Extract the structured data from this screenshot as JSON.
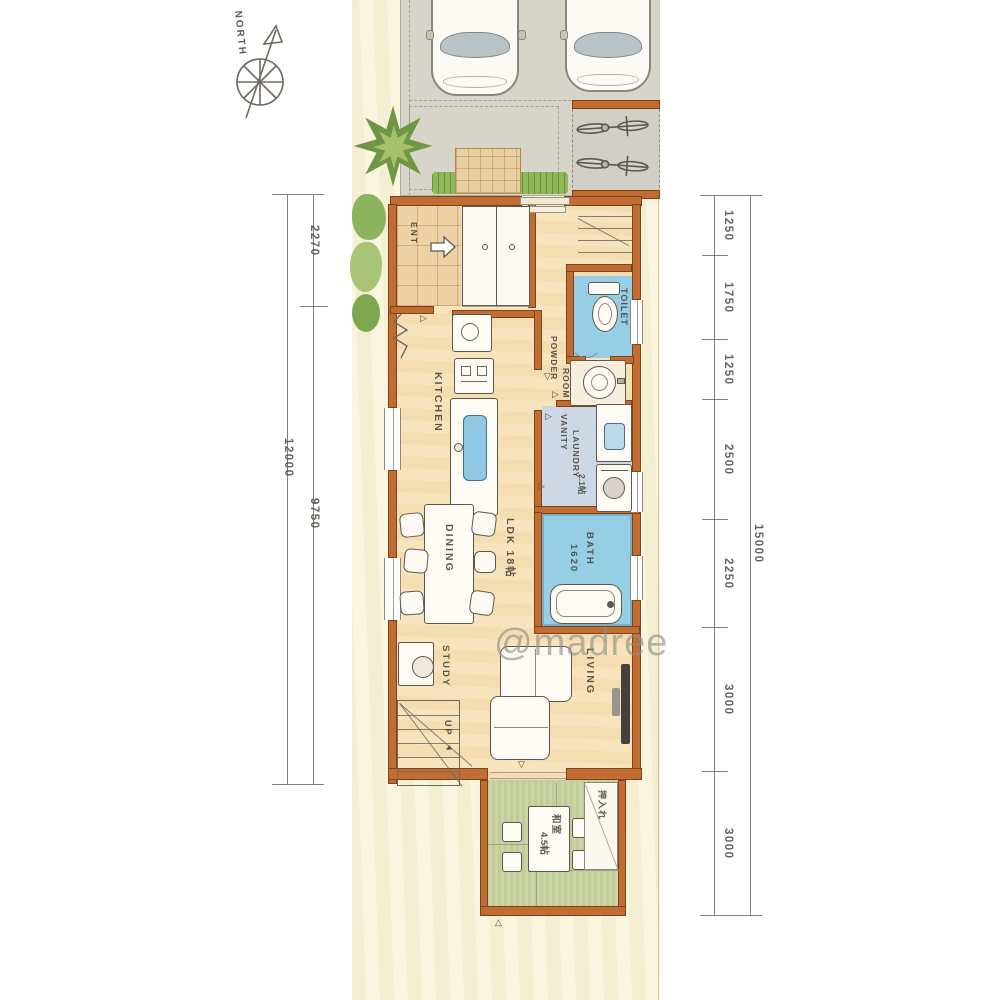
{
  "watermark": "@madree",
  "compass": {
    "north": "NORTH"
  },
  "dimensions": {
    "left_total": "12000",
    "left_seg1": "2270",
    "left_seg2": "9750",
    "right_total": "15000",
    "right_segments": [
      "1250",
      "1750",
      "1250",
      "2500",
      "2250",
      "3000",
      "3000"
    ]
  },
  "rooms": {
    "entry": "ENT",
    "toilet": "TOILET",
    "powder_line1": "POWDER",
    "powder_line2": "ROOM",
    "kitchen": "KITCHEN",
    "vanity_line1": "VANITY",
    "vanity_line2": "LAUNDRY",
    "vanity_line3": "2.1帖",
    "bath_line1": "BATH",
    "bath_line2": "1620",
    "dining": "DINING",
    "ldk": "LDK 18帖",
    "study": "STUDY",
    "up": "UP",
    "living": "LIVING",
    "tatami_line1": "和室",
    "tatami_line2": "4.5帖",
    "closet": "押入れ"
  },
  "colors": {
    "wall": "#c16c33",
    "wet_blue": "#96cfe5",
    "laundry_blue": "#ccd8e6",
    "tatami_green": "#cbd5a4",
    "floor": "#f7e4bc",
    "site": "#f9f5df",
    "driveway": "#d7d4ca",
    "grass": "#8fb657",
    "tree": "#6e9644",
    "pencil": "#6f6a60",
    "watermark_gray": "#8f8d8a"
  }
}
